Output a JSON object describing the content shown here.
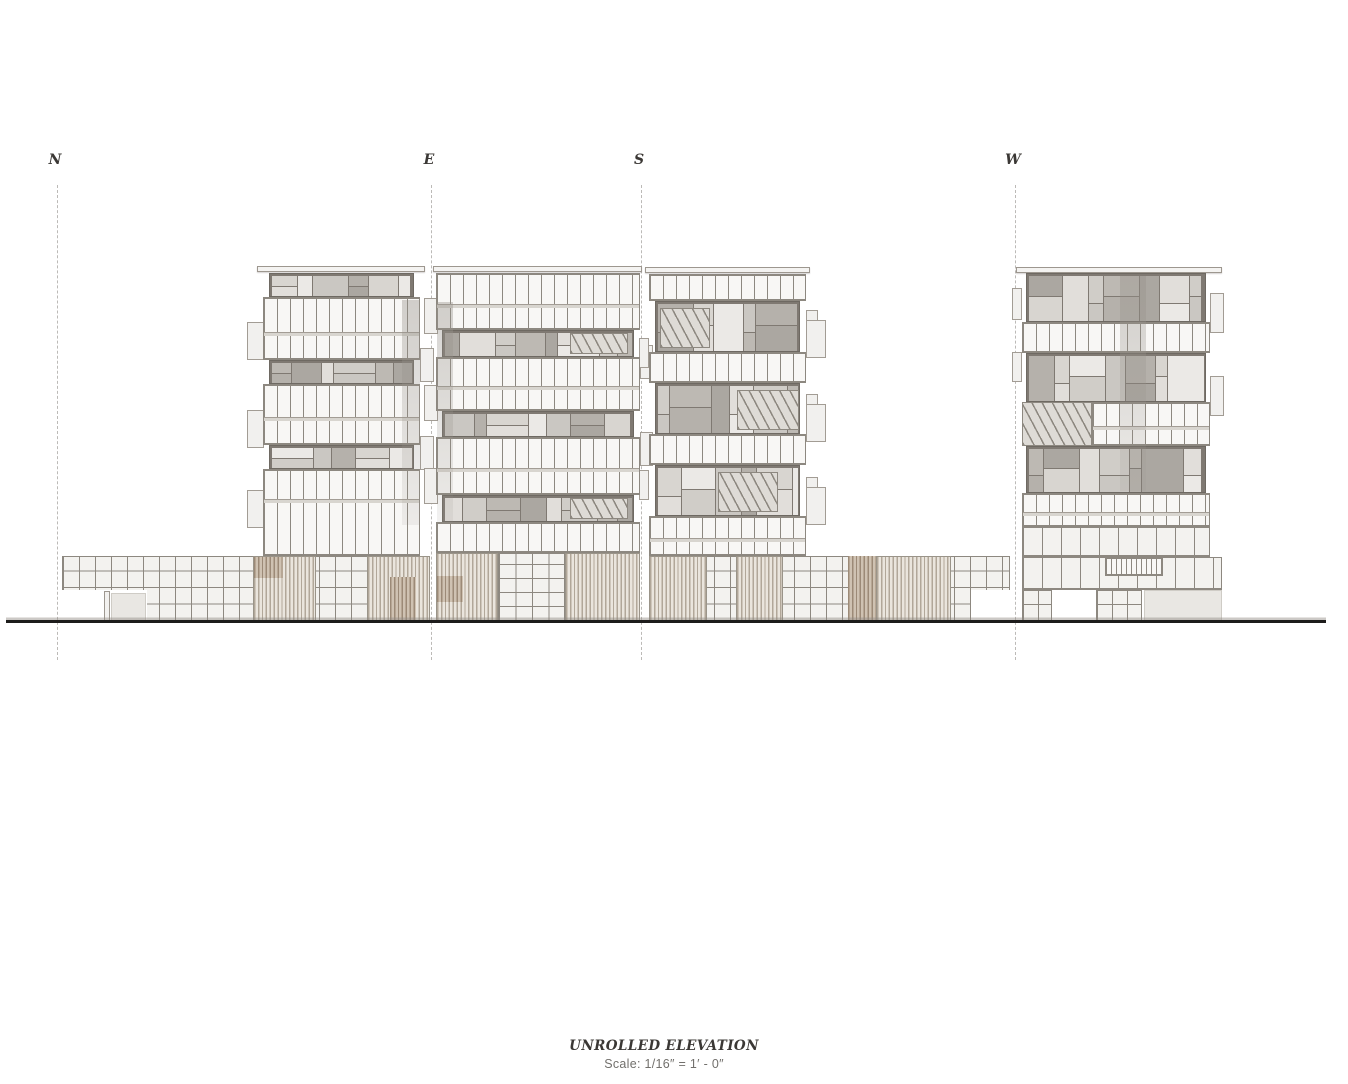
{
  "canvas": {
    "w": 1348,
    "h": 1084
  },
  "sheet": {
    "title": "UNROLLED ELEVATION",
    "scale_note": "Scale: 1/16″ = 1′ - 0″"
  },
  "markers": [
    {
      "label": "N",
      "x": 57
    },
    {
      "label": "E",
      "x": 431
    },
    {
      "label": "S",
      "x": 641
    },
    {
      "label": "W",
      "x": 1015
    }
  ],
  "marker_layout": {
    "label_top": 152,
    "line_top": 185,
    "line_bottom": 660
  },
  "ground_line": {
    "x": 6,
    "y": 620,
    "w": 1320
  },
  "title_block": {
    "center_x": 664,
    "top": 1038
  },
  "colors": {
    "line": "#8d8880",
    "pane": "#f8f7f5",
    "grid_bg": "#f3f2ef",
    "mondrian_bg": "#7f7972",
    "recess_bg": "#e9e7e3",
    "slat_dark": "#b1a799",
    "slat_light": "#eae5dd",
    "slat_dark2": "#9c8a77",
    "slat_light2": "#cfc2b2",
    "ground": "#1d1c1b",
    "dash": "#bcbab7",
    "text_dark": "#3b3835",
    "text_gray": "#72706c"
  },
  "mondrian_shades": [
    "#d8d5d0",
    "#bdb9b3",
    "#ebe9e6",
    "#aba7a1",
    "#cac7c2",
    "#e1deda",
    "#b5b1ab",
    "#d0cdc8"
  ],
  "drawing": {
    "rects": [
      {
        "type": "roof",
        "x": 257,
        "y": 266,
        "w": 168,
        "h": 6
      },
      {
        "type": "roof",
        "x": 433,
        "y": 266,
        "w": 209,
        "h": 6
      },
      {
        "type": "roof",
        "x": 645,
        "y": 267,
        "w": 165,
        "h": 6
      },
      {
        "type": "roof",
        "x": 1016,
        "y": 267,
        "w": 206,
        "h": 6
      },
      {
        "type": "ledge",
        "x": 247,
        "y": 322,
        "w": 17,
        "h": 38
      },
      {
        "type": "ledge",
        "x": 247,
        "y": 410,
        "w": 17,
        "h": 38
      },
      {
        "type": "ledge",
        "x": 247,
        "y": 490,
        "w": 17,
        "h": 38
      },
      {
        "type": "ledge",
        "x": 420,
        "y": 348,
        "w": 14,
        "h": 34
      },
      {
        "type": "ledge",
        "x": 420,
        "y": 436,
        "w": 14,
        "h": 34
      },
      {
        "type": "ledge",
        "x": 424,
        "y": 298,
        "w": 14,
        "h": 36
      },
      {
        "type": "ledge",
        "x": 424,
        "y": 385,
        "w": 14,
        "h": 36
      },
      {
        "type": "ledge",
        "x": 424,
        "y": 468,
        "w": 14,
        "h": 36
      },
      {
        "type": "ledge",
        "x": 640,
        "y": 345,
        "w": 13,
        "h": 34
      },
      {
        "type": "ledge",
        "x": 640,
        "y": 432,
        "w": 13,
        "h": 34
      },
      {
        "type": "ledge",
        "x": 806,
        "y": 310,
        "w": 12,
        "h": 16
      },
      {
        "type": "ledge",
        "x": 806,
        "y": 394,
        "w": 12,
        "h": 16
      },
      {
        "type": "ledge",
        "x": 806,
        "y": 477,
        "w": 12,
        "h": 16
      },
      {
        "type": "ledge",
        "x": 806,
        "y": 320,
        "w": 20,
        "h": 38
      },
      {
        "type": "ledge",
        "x": 806,
        "y": 404,
        "w": 20,
        "h": 38
      },
      {
        "type": "ledge",
        "x": 806,
        "y": 487,
        "w": 20,
        "h": 38
      },
      {
        "type": "ledge",
        "x": 639,
        "y": 338,
        "w": 10,
        "h": 30
      },
      {
        "type": "ledge",
        "x": 639,
        "y": 470,
        "w": 10,
        "h": 30
      },
      {
        "type": "ledge",
        "x": 1210,
        "y": 293,
        "w": 14,
        "h": 40
      },
      {
        "type": "ledge",
        "x": 1210,
        "y": 376,
        "w": 14,
        "h": 40
      },
      {
        "type": "ledge",
        "x": 1012,
        "y": 288,
        "w": 10,
        "h": 32
      },
      {
        "type": "ledge",
        "x": 1012,
        "y": 352,
        "w": 10,
        "h": 30
      },
      {
        "type": "mondrian",
        "x": 269,
        "y": 273,
        "w": 145,
        "h": 24,
        "seed": 0
      },
      {
        "type": "mullion",
        "x": 263,
        "y": 297,
        "w": 157,
        "h": 63,
        "split": 33
      },
      {
        "type": "mondrian",
        "x": 269,
        "y": 360,
        "w": 145,
        "h": 24,
        "seed": 3
      },
      {
        "type": "mullion",
        "x": 263,
        "y": 384,
        "w": 157,
        "h": 61,
        "split": 31
      },
      {
        "type": "mondrian",
        "x": 269,
        "y": 445,
        "w": 145,
        "h": 24,
        "seed": 6
      },
      {
        "type": "mullion",
        "x": 263,
        "y": 469,
        "w": 157,
        "h": 87,
        "split": 28
      },
      {
        "type": "mullion",
        "x": 436,
        "y": 273,
        "w": 204,
        "h": 57,
        "split": 29
      },
      {
        "type": "mondrian",
        "x": 442,
        "y": 330,
        "w": 192,
        "h": 27,
        "seed": 1
      },
      {
        "type": "mullion",
        "x": 436,
        "y": 357,
        "w": 204,
        "h": 54,
        "split": 27
      },
      {
        "type": "mondrian",
        "x": 442,
        "y": 411,
        "w": 192,
        "h": 26,
        "seed": 4
      },
      {
        "type": "mullion",
        "x": 436,
        "y": 437,
        "w": 204,
        "h": 58,
        "split": 29
      },
      {
        "type": "mondrian",
        "x": 442,
        "y": 495,
        "w": 192,
        "h": 27,
        "seed": 7
      },
      {
        "type": "mullion",
        "x": 436,
        "y": 522,
        "w": 204,
        "h": 31
      },
      {
        "type": "mullion",
        "x": 649,
        "y": 274,
        "w": 157,
        "h": 27
      },
      {
        "type": "mondrian",
        "x": 655,
        "y": 301,
        "w": 145,
        "h": 51,
        "seed": 2
      },
      {
        "type": "mullion",
        "x": 649,
        "y": 352,
        "w": 157,
        "h": 31
      },
      {
        "type": "mondrian",
        "x": 655,
        "y": 383,
        "w": 145,
        "h": 51,
        "seed": 5
      },
      {
        "type": "mullion",
        "x": 649,
        "y": 434,
        "w": 157,
        "h": 31
      },
      {
        "type": "mondrian",
        "x": 655,
        "y": 465,
        "w": 145,
        "h": 51,
        "seed": 8
      },
      {
        "type": "mullion",
        "x": 649,
        "y": 516,
        "w": 157,
        "h": 40,
        "split": 20
      },
      {
        "type": "mondrian",
        "x": 1026,
        "y": 273,
        "w": 180,
        "h": 49,
        "seed": 9
      },
      {
        "type": "mullion",
        "x": 1022,
        "y": 322,
        "w": 188,
        "h": 31
      },
      {
        "type": "mondrian",
        "x": 1026,
        "y": 353,
        "w": 180,
        "h": 49,
        "seed": 10
      },
      {
        "type": "stair",
        "x": 1022,
        "y": 402,
        "w": 70,
        "h": 44
      },
      {
        "type": "mullion",
        "x": 1092,
        "y": 402,
        "w": 118,
        "h": 44,
        "split": 22
      },
      {
        "type": "mondrian",
        "x": 1026,
        "y": 446,
        "w": 180,
        "h": 47,
        "seed": 11
      },
      {
        "type": "mullion",
        "x": 1022,
        "y": 493,
        "w": 188,
        "h": 34,
        "split": 17
      },
      {
        "type": "grid",
        "x": 62,
        "y": 556,
        "w": 368,
        "h": 66,
        "cw": 16,
        "ch": 16.5
      },
      {
        "type": "open",
        "x": 62,
        "y": 590,
        "w": 85,
        "h": 33
      },
      {
        "type": "plain",
        "x": 104,
        "y": 591,
        "w": 6,
        "h": 31
      },
      {
        "type": "recess",
        "x": 111,
        "y": 593,
        "w": 35,
        "h": 28
      },
      {
        "type": "slats",
        "x": 253,
        "y": 556,
        "w": 63,
        "h": 66
      },
      {
        "type": "slats_dark",
        "x": 254,
        "y": 557,
        "w": 29,
        "h": 21
      },
      {
        "type": "slats",
        "x": 367,
        "y": 556,
        "w": 63,
        "h": 66
      },
      {
        "type": "slats_dark",
        "x": 390,
        "y": 577,
        "w": 26,
        "h": 44
      },
      {
        "type": "slats",
        "x": 436,
        "y": 553,
        "w": 62,
        "h": 69
      },
      {
        "type": "slats_dark",
        "x": 437,
        "y": 576,
        "w": 26,
        "h": 26
      },
      {
        "type": "grid",
        "x": 498,
        "y": 553,
        "w": 67,
        "h": 69,
        "cw": 16.5,
        "ch": 14
      },
      {
        "type": "slats",
        "x": 565,
        "y": 553,
        "w": 75,
        "h": 69
      },
      {
        "type": "grid",
        "x": 649,
        "y": 556,
        "w": 361,
        "h": 66,
        "cw": 16,
        "ch": 16.5
      },
      {
        "type": "slats",
        "x": 649,
        "y": 556,
        "w": 58,
        "h": 66
      },
      {
        "type": "slats",
        "x": 736,
        "y": 556,
        "w": 47,
        "h": 66
      },
      {
        "type": "slats_dark",
        "x": 848,
        "y": 556,
        "w": 28,
        "h": 66
      },
      {
        "type": "slats",
        "x": 876,
        "y": 556,
        "w": 75,
        "h": 66
      },
      {
        "type": "open",
        "x": 971,
        "y": 590,
        "w": 39,
        "h": 32
      },
      {
        "type": "grid",
        "x": 1022,
        "y": 527,
        "w": 188,
        "h": 30,
        "cw": 19,
        "ch": 30
      },
      {
        "type": "grid",
        "x": 1022,
        "y": 557,
        "w": 200,
        "h": 33,
        "cw": 19,
        "ch": 33
      },
      {
        "type": "mullion",
        "x": 1105,
        "y": 557,
        "w": 58,
        "h": 19,
        "gap": 5
      },
      {
        "type": "grid",
        "x": 1022,
        "y": 590,
        "w": 30,
        "h": 32,
        "cw": 15,
        "ch": 16
      },
      {
        "type": "grid",
        "x": 1096,
        "y": 590,
        "w": 46,
        "h": 32,
        "cw": 15,
        "ch": 16
      },
      {
        "type": "recess",
        "x": 1144,
        "y": 590,
        "w": 78,
        "h": 31
      },
      {
        "type": "stair",
        "x": 570,
        "y": 333,
        "w": 58,
        "h": 21
      },
      {
        "type": "stair",
        "x": 570,
        "y": 498,
        "w": 58,
        "h": 21
      },
      {
        "type": "stair",
        "x": 660,
        "y": 308,
        "w": 50,
        "h": 40
      },
      {
        "type": "stair",
        "x": 737,
        "y": 390,
        "w": 62,
        "h": 40
      },
      {
        "type": "stair",
        "x": 718,
        "y": 472,
        "w": 60,
        "h": 40
      },
      {
        "type": "streak",
        "x": 402,
        "y": 300,
        "w": 18,
        "h": 225
      },
      {
        "type": "streak",
        "x": 437,
        "y": 302,
        "w": 16,
        "h": 220
      },
      {
        "type": "streak",
        "x": 1120,
        "y": 276,
        "w": 26,
        "h": 215
      }
    ]
  }
}
